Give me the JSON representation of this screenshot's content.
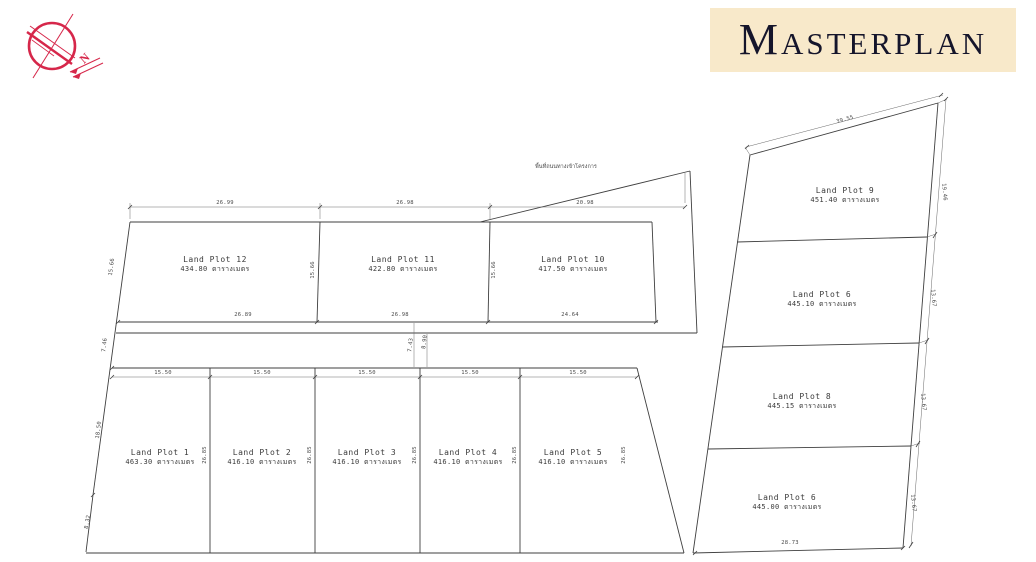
{
  "banner": {
    "title": "Masterplan",
    "bg": "#f8e9ca",
    "text_color": "#15152b"
  },
  "compass": {
    "label": "N",
    "color": "#d6274a"
  },
  "road_note": "พื้นที่ถนนทางเข้าโครงการ",
  "unit": "ตารางเมตร",
  "top_row": {
    "plots": [
      {
        "name": "Land Plot 12",
        "area": "434.80 ตารางเมตร"
      },
      {
        "name": "Land Plot 11",
        "area": "422.80 ตารางเมตร"
      },
      {
        "name": "Land Plot 10",
        "area": "417.50 ตารางเมตร"
      }
    ],
    "dims_top": [
      "26.99",
      "26.98",
      "20.98"
    ],
    "dims_bottom": [
      "26.89",
      "26.98",
      "24.64"
    ],
    "dims_height": [
      "15.66",
      "15.66"
    ]
  },
  "bottom_row": {
    "plots": [
      {
        "name": "Land Plot 1",
        "area": "463.30 ตารางเมตร"
      },
      {
        "name": "Land Plot 2",
        "area": "416.10 ตารางเมตร"
      },
      {
        "name": "Land Plot 3",
        "area": "416.10 ตารางเมตร"
      },
      {
        "name": "Land Plot 4",
        "area": "416.10 ตารางเมตร"
      },
      {
        "name": "Land Plot 5",
        "area": "416.10 ตารางเมตร"
      }
    ],
    "dims_width": [
      "15.50",
      "15.50",
      "15.50",
      "15.50",
      "15.50"
    ],
    "dims_height": [
      "26.85",
      "26.85",
      "26.85",
      "26.85",
      "26.85"
    ]
  },
  "left_edge_dims": [
    "15.66",
    "7.46",
    "18.50",
    "8.32"
  ],
  "gap_dims": [
    "7.43",
    "8.90"
  ],
  "right_col": {
    "plots": [
      {
        "name": "Land Plot 9",
        "area": "451.40 ตารางเมตร"
      },
      {
        "name": "Land Plot 6",
        "area": "445.10 ตารางเมตร"
      },
      {
        "name": "Land Plot 8",
        "area": "445.15 ตารางเมตร"
      },
      {
        "name": "Land Plot 6",
        "area": "445.00 ตารางเมตร"
      }
    ],
    "dim_top": "39.55",
    "dims_right": [
      "19.46",
      "13.67",
      "13.67",
      "13.67"
    ],
    "dim_bottom": "28.73"
  }
}
